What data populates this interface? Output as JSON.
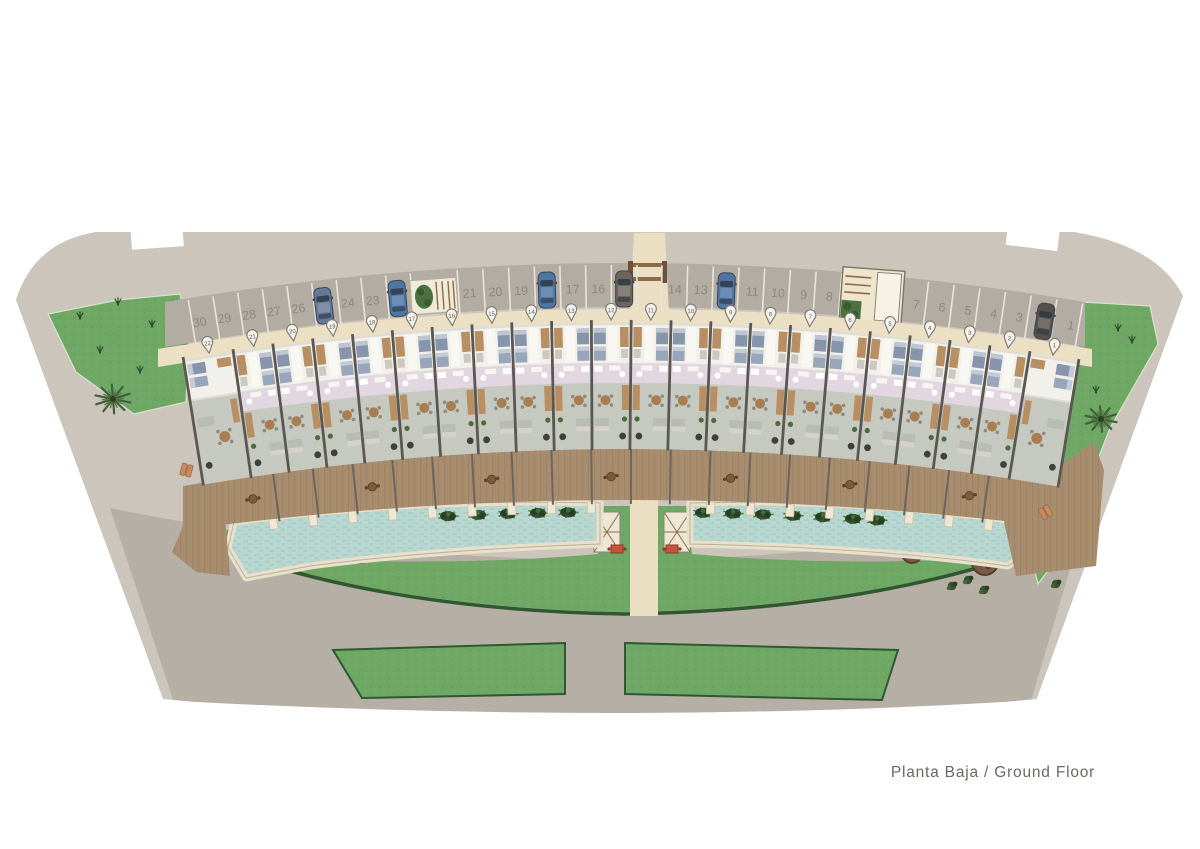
{
  "plan": {
    "title": "Planta Baja / Ground Floor"
  },
  "parking": {
    "stall_numbers": [
      "30",
      "29",
      "28",
      "27",
      "26",
      "25",
      "24",
      "23",
      "22",
      "21",
      "20",
      "19",
      "18",
      "17",
      "16",
      "15",
      "14",
      "13",
      "12",
      "11",
      "10",
      "9",
      "8",
      "7",
      "6",
      "5",
      "4",
      "3",
      "2",
      "1"
    ],
    "occupied_stalls": [
      "25",
      "22",
      "18",
      "15",
      "12",
      "2"
    ],
    "car_colors": {
      "25": "#64789a",
      "22": "#4d76a4",
      "18": "#4d76a4",
      "15": "#6f6459",
      "12": "#4d76a4",
      "2": "#55514a"
    }
  },
  "units": {
    "marker_numbers": [
      "22",
      "21",
      "20",
      "19",
      "18",
      "17",
      "16",
      "15",
      "14",
      "13",
      "12",
      "11",
      "10",
      "9",
      "8",
      "7",
      "6",
      "5",
      "4",
      "3",
      "2",
      "1"
    ]
  },
  "icons": {
    "unit_marker": "map-pin-icon",
    "car": "car-top-view-icon",
    "palm": "palm-tree-icon",
    "tree": "round-tree-icon",
    "shrub": "shrub-icon",
    "plant": "pool-plant-icon"
  },
  "colors": {
    "road": "#cbc5bc",
    "road_dark": "#b5afa6",
    "asphalt_parking": "#b2aca3",
    "stall_line": "#e9e4da",
    "stall_number": "#8d8780",
    "walkway": "#ece0c4",
    "driveway": "#eadfc2",
    "grass": "#6fa765",
    "grass_edge": "#2f5730",
    "pool_water": "#b7d7d0",
    "pool_stone": "#e8e0cb",
    "deck_wood": "#a78c6d",
    "building_wall": "#5b5752",
    "bed": "#8695ac",
    "label_text": "#6b6862"
  }
}
